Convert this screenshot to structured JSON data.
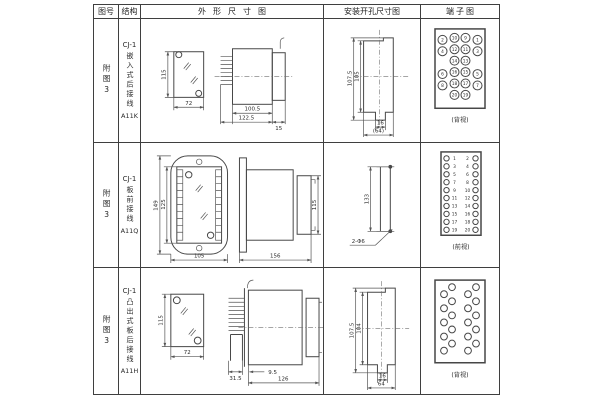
{
  "table": {
    "headers": {
      "fig": "图号",
      "struct": "结构",
      "outline": "外形尺寸图",
      "install": "安装开孔尺寸图",
      "terminal": "端子图"
    },
    "rows": [
      {
        "fig": "附图3",
        "model": "CJ-1",
        "desc": "嵌入式后接线",
        "code": "A11K",
        "outline": {
          "height": "115",
          "width": "72",
          "body_len": "100.5",
          "total_len": "122.5",
          "rear_len": "15"
        },
        "install": {
          "outer_h": "107.5",
          "inner_h": "105",
          "slot_w": "16",
          "total_w": "(64)"
        },
        "terminal": {
          "view": "(背视)",
          "outer_left": [
            "2",
            "4",
            "6",
            "8"
          ],
          "inner_left": [
            "10",
            "12",
            "14",
            "16",
            "18",
            "20"
          ],
          "inner_right": [
            "9",
            "11",
            "13",
            "15",
            "17",
            "19"
          ],
          "outer_right": [
            "1",
            "3",
            "5",
            "7"
          ]
        }
      },
      {
        "fig": "附图3",
        "model": "CJ-1",
        "desc": "板前接线",
        "code": "A11Q",
        "outline": {
          "outer_h": "149",
          "inner_h": "125",
          "width": "105",
          "length": "156",
          "side_h": "115"
        },
        "install": {
          "hole_dist": "133",
          "holes": "2-Φ6"
        },
        "terminal": {
          "view": "(前视)",
          "left": [
            "1",
            "3",
            "5",
            "7",
            "9",
            "11",
            "13",
            "15",
            "17",
            "19"
          ],
          "right": [
            "2",
            "4",
            "6",
            "8",
            "10",
            "12",
            "14",
            "16",
            "18",
            "20"
          ]
        }
      },
      {
        "fig": "附图3",
        "model": "CJ-1",
        "desc": "凸出式板后接线",
        "code": "A11H",
        "outline": {
          "height": "115",
          "width": "72",
          "plug_len": "31.5",
          "offset": "9.5",
          "total_len": "126"
        },
        "install": {
          "outer_h": "107.5",
          "inner_h": "104",
          "slot_w": "16",
          "total_w": "64"
        },
        "terminal": {
          "view": "(背视)"
        }
      }
    ]
  }
}
